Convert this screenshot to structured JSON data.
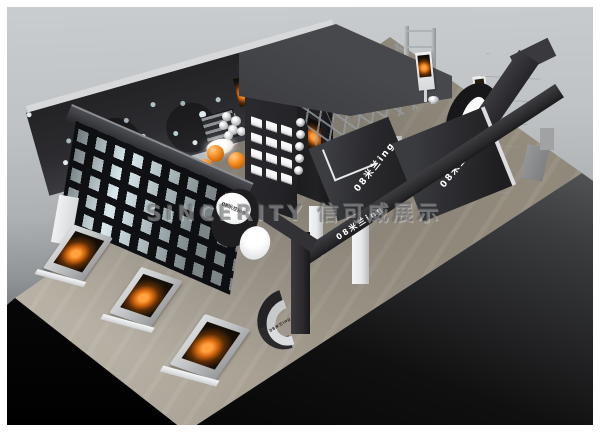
{
  "image": {
    "type": "3D exhibition booth design render",
    "watermark": "SINCERITY 信可威展示",
    "brand": "08米兰ing"
  },
  "signs": {
    "oval_logo": "08米兰ing",
    "front_beam": "08米兰ing",
    "canopy_left": "08米兰ing",
    "canopy_right": "08米兰ing",
    "tower_beam": "08米兰ing",
    "reception_desk": "08米兰ing"
  },
  "palette": {
    "background_top": "#c9cdcf",
    "background_bottom": "#030303",
    "floor": "#aaa294",
    "booth_dark": "#2a2a2d",
    "booth_top_face": "#46474b",
    "panel_white": "#eef0f0",
    "accent_orange": "#e87712",
    "watermark_gray": "#6c6e70"
  }
}
